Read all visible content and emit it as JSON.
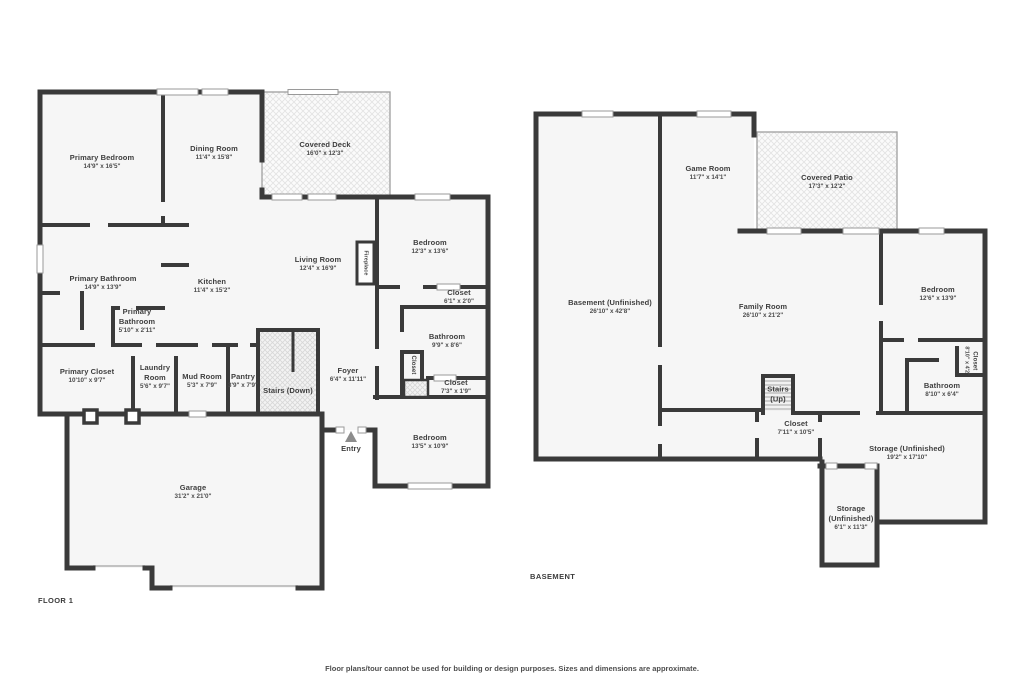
{
  "meta": {
    "disclaimer": "Floor plans/tour cannot be used for building or design purposes. Sizes and dimensions are approximate."
  },
  "colors": {
    "wall": "#3a3a3a",
    "room_fill": "#f6f6f6",
    "hatch_line": "#e3e3e3",
    "window_border": "#9a9a9a",
    "text": "#3e3e3e",
    "entry_arrow": "#8d8d8d"
  },
  "floor1": {
    "label": "FLOOR 1",
    "rooms": [
      {
        "id": "primary-bedroom",
        "name": "Primary Bedroom",
        "dims": "14'9\" x 16'5\"",
        "cx": 102,
        "cy": 162
      },
      {
        "id": "dining-room",
        "name": "Dining Room",
        "dims": "11'4\" x 15'8\"",
        "cx": 214,
        "cy": 153
      },
      {
        "id": "covered-deck",
        "name": "Covered Deck",
        "dims": "16'0\" x 12'3\"",
        "cx": 325,
        "cy": 149
      },
      {
        "id": "bedroom-1",
        "name": "Bedroom",
        "dims": "12'3\" x 13'6\"",
        "cx": 430,
        "cy": 247
      },
      {
        "id": "living-room",
        "name": "Living Room",
        "dims": "12'4\" x 16'9\"",
        "cx": 318,
        "cy": 264
      },
      {
        "id": "fireplace",
        "name": "Fireplace",
        "dims": "",
        "cx": 365,
        "cy": 263,
        "vertical": true,
        "tiny": true
      },
      {
        "id": "kitchen",
        "name": "Kitchen",
        "dims": "11'4\" x 15'2\"",
        "cx": 212,
        "cy": 286
      },
      {
        "id": "primary-bathroom",
        "name": "Primary Bathroom",
        "dims": "14'9\" x 13'9\"",
        "cx": 103,
        "cy": 283
      },
      {
        "id": "primary-bathroom-2",
        "name": "Primary Bathroom",
        "dims": "5'10\" x 2'11\"",
        "cx": 137,
        "cy": 321,
        "w": 46
      },
      {
        "id": "primary-closet",
        "name": "Primary Closet",
        "dims": "10'10\" x 9'7\"",
        "cx": 87,
        "cy": 376
      },
      {
        "id": "laundry-room",
        "name": "Laundry Room",
        "dims": "5'6\" x 9'7\"",
        "cx": 155,
        "cy": 377,
        "w": 42
      },
      {
        "id": "mud-room",
        "name": "Mud Room",
        "dims": "5'3\" x 7'9\"",
        "cx": 202,
        "cy": 381
      },
      {
        "id": "pantry",
        "name": "Pantry",
        "dims": "3'9\" x 7'9\"",
        "cx": 243,
        "cy": 381
      },
      {
        "id": "stairs-down",
        "name": "Stairs (Down)",
        "dims": "",
        "cx": 288,
        "cy": 391
      },
      {
        "id": "foyer",
        "name": "Foyer",
        "dims": "6'4\" x 11'11\"",
        "cx": 348,
        "cy": 375
      },
      {
        "id": "closet-1",
        "name": "Closet",
        "dims": "6'1\" x 2'0\"",
        "cx": 459,
        "cy": 297
      },
      {
        "id": "bathroom-1",
        "name": "Bathroom",
        "dims": "9'9\" x 8'6\"",
        "cx": 447,
        "cy": 341
      },
      {
        "id": "closet-hall",
        "name": "Closet",
        "dims": "",
        "cx": 412,
        "cy": 365,
        "vertical": true
      },
      {
        "id": "closet-2",
        "name": "Closet",
        "dims": "7'3\" x 1'9\"",
        "cx": 456,
        "cy": 387
      },
      {
        "id": "bedroom-2",
        "name": "Bedroom",
        "dims": "13'5\" x 10'9\"",
        "cx": 430,
        "cy": 442
      },
      {
        "id": "garage",
        "name": "Garage",
        "dims": "31'2\" x 21'0\"",
        "cx": 193,
        "cy": 492
      },
      {
        "id": "entry",
        "name": "Entry",
        "dims": "",
        "cx": 351,
        "cy": 449
      }
    ]
  },
  "basement": {
    "label": "BASEMENT",
    "rooms": [
      {
        "id": "basement-unfinished",
        "name": "Basement (Unfinished)",
        "dims": "26'10\" x 42'8\"",
        "cx": 610,
        "cy": 307
      },
      {
        "id": "game-room",
        "name": "Game Room",
        "dims": "11'7\" x 14'1\"",
        "cx": 708,
        "cy": 173
      },
      {
        "id": "covered-patio",
        "name": "Covered Patio",
        "dims": "17'3\" x 12'2\"",
        "cx": 827,
        "cy": 182
      },
      {
        "id": "family-room",
        "name": "Family Room",
        "dims": "26'10\" x 21'2\"",
        "cx": 763,
        "cy": 311
      },
      {
        "id": "bedroom-3",
        "name": "Bedroom",
        "dims": "12'6\" x 13'9\"",
        "cx": 938,
        "cy": 294
      },
      {
        "id": "closet-3",
        "name": "Closet",
        "dims": "8'10\" x 4'2\"",
        "cx": 970,
        "cy": 361,
        "vertical": true
      },
      {
        "id": "bathroom-2",
        "name": "Bathroom",
        "dims": "8'10\" x 6'4\"",
        "cx": 942,
        "cy": 390
      },
      {
        "id": "stairs-up",
        "name": "Stairs (Up)",
        "dims": "",
        "cx": 778,
        "cy": 394,
        "w": 32
      },
      {
        "id": "closet-4",
        "name": "Closet",
        "dims": "7'11\" x 10'5\"",
        "cx": 796,
        "cy": 428
      },
      {
        "id": "storage-1",
        "name": "Storage (Unfinished)",
        "dims": "19'2\" x 17'10\"",
        "cx": 907,
        "cy": 453
      },
      {
        "id": "storage-2",
        "name": "Storage (Unfinished)",
        "dims": "6'1\" x 11'3\"",
        "cx": 851,
        "cy": 518,
        "w": 56
      }
    ]
  }
}
